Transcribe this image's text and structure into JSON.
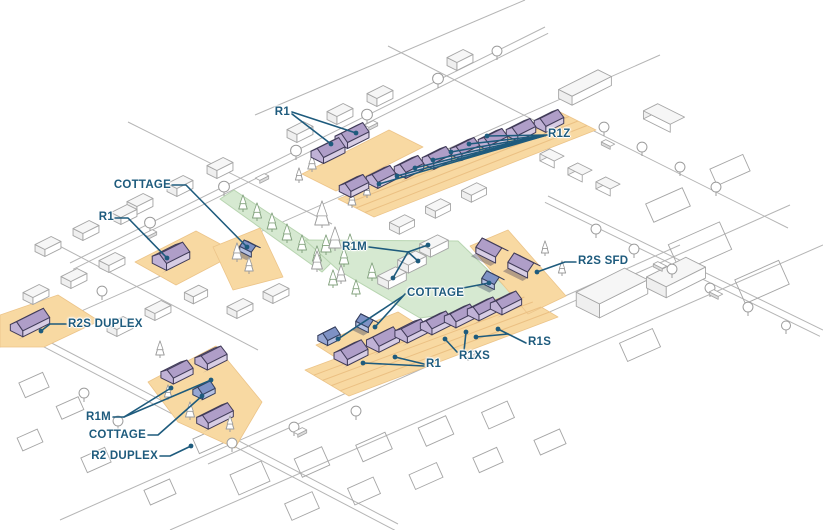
{
  "figure": {
    "kind": "isometric neighborhood zoning illustration",
    "background": "#ffffff"
  },
  "colors": {
    "label_text": "#1E5B7D",
    "leader_line": "#1E5B7D",
    "lot_fill": "#F8D9A2",
    "lot_edge": "#ECC489",
    "lot_hatch": "#EBC083",
    "park_fill": "#D6E9D1",
    "park_edge": "#B8D5B1",
    "park_tree": "#84A37F",
    "house_roof": "#AF9EC8",
    "house_wall": "#D7CDE4",
    "house_gable": "#C0B2D6",
    "house_outline": "#423D5A",
    "cottage_roof": "#7E92C5",
    "cottage_wall": "#B4C0E1",
    "cottage_gable": "#97A7D3",
    "cottage_outline": "#343E5D",
    "context_line": "#A5A5A5",
    "context_top": "#F6F6F6",
    "context_side": "#FFFFFF",
    "context_gable": "#EFEFEF",
    "street_line": "#B5B5B5",
    "tree_gray": "#9C9C9C",
    "car_fill": "#DCDCDC"
  },
  "callouts": [
    {
      "id": "r1-top",
      "text": "R1"
    },
    {
      "id": "r1z",
      "text": "R1Z"
    },
    {
      "id": "cottage-top-left",
      "text": "COTTAGE"
    },
    {
      "id": "r1-left",
      "text": "R1"
    },
    {
      "id": "r1m-center",
      "text": "R1M"
    },
    {
      "id": "r2s-sfd",
      "text": "R2S SFD"
    },
    {
      "id": "cottage-center",
      "text": "COTTAGE"
    },
    {
      "id": "r2s-duplex",
      "text": "R2S DUPLEX"
    },
    {
      "id": "r1s",
      "text": "R1S"
    },
    {
      "id": "r1xs",
      "text": "R1XS"
    },
    {
      "id": "r1-center",
      "text": "R1"
    },
    {
      "id": "r1m-bottom-left",
      "text": "R1M"
    },
    {
      "id": "cottage-bottom-left",
      "text": "COTTAGE"
    },
    {
      "id": "r2-duplex",
      "text": "R2 DUPLEX"
    }
  ]
}
